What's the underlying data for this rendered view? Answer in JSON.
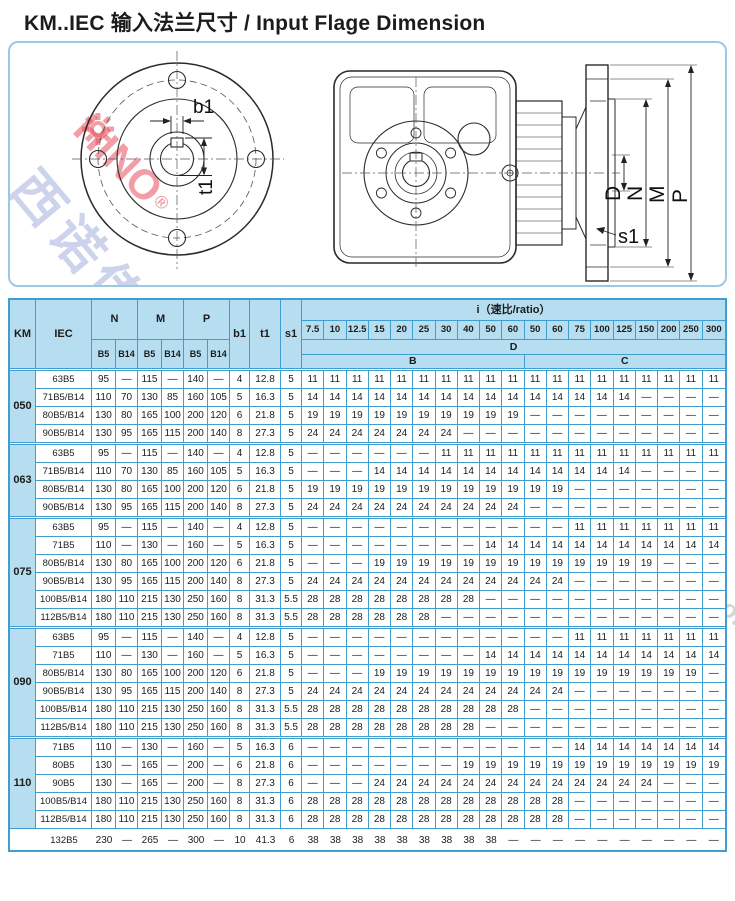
{
  "title": "KM..IEC 输入法兰尺寸 / Input Flage Dimension",
  "diagram": {
    "flange_labels": {
      "b1": "b1",
      "t1": "t1"
    },
    "side_labels": {
      "d": "D",
      "n": "N",
      "m": "M",
      "p": "P",
      "s1": "s1"
    }
  },
  "watermark": {
    "logo_text": "HINO",
    "logo_reg": "®",
    "cn_small": "西诺传动",
    "cn": "陕西西诺传动科技有限公司",
    "en": "Shaanxi Xino Drive Technology Co.,Ltd"
  },
  "table": {
    "header": {
      "km": "KM",
      "iec": "IEC",
      "n": "N",
      "m": "M",
      "p": "P",
      "b5": "B5",
      "b14": "B14",
      "b1": "b1",
      "t1": "t1",
      "s1": "s1",
      "ratio_title": "i（速比/ratio）",
      "ratios": [
        "7.5",
        "10",
        "12.5",
        "15",
        "20",
        "25",
        "30",
        "40",
        "50",
        "60",
        "50",
        "60",
        "75",
        "100",
        "125",
        "150",
        "200",
        "250",
        "300"
      ],
      "d": "D",
      "b": "B",
      "c": "C"
    },
    "groups": [
      {
        "km": "050",
        "rows": [
          {
            "iec": "63B5",
            "dims": [
              "95",
              "—",
              "115",
              "—",
              "140",
              "—",
              "4",
              "12.8",
              "5"
            ],
            "i": [
              "11",
              "11",
              "11",
              "11",
              "11",
              "11",
              "11",
              "11",
              "11",
              "11",
              "11",
              "11",
              "11",
              "11",
              "11",
              "11",
              "11",
              "11",
              "11"
            ]
          },
          {
            "iec": "71B5/B14",
            "dims": [
              "110",
              "70",
              "130",
              "85",
              "160",
              "105",
              "5",
              "16.3",
              "5"
            ],
            "i": [
              "14",
              "14",
              "14",
              "14",
              "14",
              "14",
              "14",
              "14",
              "14",
              "14",
              "14",
              "14",
              "14",
              "14",
              "14",
              "—",
              "—",
              "—",
              "—"
            ]
          },
          {
            "iec": "80B5/B14",
            "dims": [
              "130",
              "80",
              "165",
              "100",
              "200",
              "120",
              "6",
              "21.8",
              "5"
            ],
            "i": [
              "19",
              "19",
              "19",
              "19",
              "19",
              "19",
              "19",
              "19",
              "19",
              "19",
              "—",
              "—",
              "—",
              "—",
              "—",
              "—",
              "—",
              "—",
              "—"
            ]
          },
          {
            "iec": "90B5/B14",
            "dims": [
              "130",
              "95",
              "165",
              "115",
              "200",
              "140",
              "8",
              "27.3",
              "5"
            ],
            "i": [
              "24",
              "24",
              "24",
              "24",
              "24",
              "24",
              "24",
              "—",
              "—",
              "—",
              "—",
              "—",
              "—",
              "—",
              "—",
              "—",
              "—",
              "—",
              "—"
            ]
          }
        ]
      },
      {
        "km": "063",
        "rows": [
          {
            "iec": "63B5",
            "dims": [
              "95",
              "—",
              "115",
              "—",
              "140",
              "—",
              "4",
              "12.8",
              "5"
            ],
            "i": [
              "—",
              "—",
              "—",
              "—",
              "—",
              "—",
              "11",
              "11",
              "11",
              "11",
              "11",
              "11",
              "11",
              "11",
              "11",
              "11",
              "11",
              "11",
              "11"
            ]
          },
          {
            "iec": "71B5/B14",
            "dims": [
              "110",
              "70",
              "130",
              "85",
              "160",
              "105",
              "5",
              "16.3",
              "5"
            ],
            "i": [
              "—",
              "—",
              "—",
              "14",
              "14",
              "14",
              "14",
              "14",
              "14",
              "14",
              "14",
              "14",
              "14",
              "14",
              "14",
              "—",
              "—",
              "—",
              "—"
            ]
          },
          {
            "iec": "80B5/B14",
            "dims": [
              "130",
              "80",
              "165",
              "100",
              "200",
              "120",
              "6",
              "21.8",
              "5"
            ],
            "i": [
              "19",
              "19",
              "19",
              "19",
              "19",
              "19",
              "19",
              "19",
              "19",
              "19",
              "19",
              "19",
              "—",
              "—",
              "—",
              "—",
              "—",
              "—",
              "—"
            ]
          },
          {
            "iec": "90B5/B14",
            "dims": [
              "130",
              "95",
              "165",
              "115",
              "200",
              "140",
              "8",
              "27.3",
              "5"
            ],
            "i": [
              "24",
              "24",
              "24",
              "24",
              "24",
              "24",
              "24",
              "24",
              "24",
              "24",
              "—",
              "—",
              "—",
              "—",
              "—",
              "—",
              "—",
              "—",
              "—"
            ]
          }
        ]
      },
      {
        "km": "075",
        "rows": [
          {
            "iec": "63B5",
            "dims": [
              "95",
              "—",
              "115",
              "—",
              "140",
              "—",
              "4",
              "12.8",
              "5"
            ],
            "i": [
              "—",
              "—",
              "—",
              "—",
              "—",
              "—",
              "—",
              "—",
              "—",
              "—",
              "—",
              "—",
              "11",
              "11",
              "11",
              "11",
              "11",
              "11",
              "11"
            ]
          },
          {
            "iec": "71B5",
            "dims": [
              "110",
              "—",
              "130",
              "—",
              "160",
              "—",
              "5",
              "16.3",
              "5"
            ],
            "i": [
              "—",
              "—",
              "—",
              "—",
              "—",
              "—",
              "—",
              "—",
              "14",
              "14",
              "14",
              "14",
              "14",
              "14",
              "14",
              "14",
              "14",
              "14",
              "14"
            ]
          },
          {
            "iec": "80B5/B14",
            "dims": [
              "130",
              "80",
              "165",
              "100",
              "200",
              "120",
              "6",
              "21.8",
              "5"
            ],
            "i": [
              "—",
              "—",
              "—",
              "19",
              "19",
              "19",
              "19",
              "19",
              "19",
              "19",
              "19",
              "19",
              "19",
              "19",
              "19",
              "19",
              "—",
              "—",
              "—"
            ]
          },
          {
            "iec": "90B5/B14",
            "dims": [
              "130",
              "95",
              "165",
              "115",
              "200",
              "140",
              "8",
              "27.3",
              "5"
            ],
            "i": [
              "24",
              "24",
              "24",
              "24",
              "24",
              "24",
              "24",
              "24",
              "24",
              "24",
              "24",
              "24",
              "—",
              "—",
              "—",
              "—",
              "—",
              "—",
              "—"
            ]
          },
          {
            "iec": "100B5/B14",
            "dims": [
              "180",
              "110",
              "215",
              "130",
              "250",
              "160",
              "8",
              "31.3",
              "5.5"
            ],
            "i": [
              "28",
              "28",
              "28",
              "28",
              "28",
              "28",
              "28",
              "28",
              "—",
              "—",
              "—",
              "—",
              "—",
              "—",
              "—",
              "—",
              "—",
              "—",
              "—"
            ]
          },
          {
            "iec": "112B5/B14",
            "dims": [
              "180",
              "110",
              "215",
              "130",
              "250",
              "160",
              "8",
              "31.3",
              "5.5"
            ],
            "i": [
              "28",
              "28",
              "28",
              "28",
              "28",
              "28",
              "—",
              "—",
              "—",
              "—",
              "—",
              "—",
              "—",
              "—",
              "—",
              "—",
              "—",
              "—",
              "—"
            ]
          }
        ]
      },
      {
        "km": "090",
        "rows": [
          {
            "iec": "63B5",
            "dims": [
              "95",
              "—",
              "115",
              "—",
              "140",
              "—",
              "4",
              "12.8",
              "5"
            ],
            "i": [
              "—",
              "—",
              "—",
              "—",
              "—",
              "—",
              "—",
              "—",
              "—",
              "—",
              "—",
              "—",
              "11",
              "11",
              "11",
              "11",
              "11",
              "11",
              "11"
            ]
          },
          {
            "iec": "71B5",
            "dims": [
              "110",
              "—",
              "130",
              "—",
              "160",
              "—",
              "5",
              "16.3",
              "5"
            ],
            "i": [
              "—",
              "—",
              "—",
              "—",
              "—",
              "—",
              "—",
              "—",
              "14",
              "14",
              "14",
              "14",
              "14",
              "14",
              "14",
              "14",
              "14",
              "14",
              "14"
            ]
          },
          {
            "iec": "80B5/B14",
            "dims": [
              "130",
              "80",
              "165",
              "100",
              "200",
              "120",
              "6",
              "21.8",
              "5"
            ],
            "i": [
              "—",
              "—",
              "—",
              "19",
              "19",
              "19",
              "19",
              "19",
              "19",
              "19",
              "19",
              "19",
              "19",
              "19",
              "19",
              "19",
              "19",
              "19",
              "—"
            ]
          },
          {
            "iec": "90B5/B14",
            "dims": [
              "130",
              "95",
              "165",
              "115",
              "200",
              "140",
              "8",
              "27.3",
              "5"
            ],
            "i": [
              "24",
              "24",
              "24",
              "24",
              "24",
              "24",
              "24",
              "24",
              "24",
              "24",
              "24",
              "24",
              "—",
              "—",
              "—",
              "—",
              "—",
              "—",
              "—"
            ]
          },
          {
            "iec": "100B5/B14",
            "dims": [
              "180",
              "110",
              "215",
              "130",
              "250",
              "160",
              "8",
              "31.3",
              "5.5"
            ],
            "i": [
              "28",
              "28",
              "28",
              "28",
              "28",
              "28",
              "28",
              "28",
              "28",
              "28",
              "—",
              "—",
              "—",
              "—",
              "—",
              "—",
              "—",
              "—",
              "—"
            ]
          },
          {
            "iec": "112B5/B14",
            "dims": [
              "180",
              "110",
              "215",
              "130",
              "250",
              "160",
              "8",
              "31.3",
              "5.5"
            ],
            "i": [
              "28",
              "28",
              "28",
              "28",
              "28",
              "28",
              "28",
              "28",
              "—",
              "—",
              "—",
              "—",
              "—",
              "—",
              "—",
              "—",
              "—",
              "—",
              "—"
            ]
          }
        ]
      },
      {
        "km": "110",
        "rows": [
          {
            "iec": "71B5",
            "dims": [
              "110",
              "—",
              "130",
              "—",
              "160",
              "—",
              "5",
              "16.3",
              "6"
            ],
            "i": [
              "—",
              "—",
              "—",
              "—",
              "—",
              "—",
              "—",
              "—",
              "—",
              "—",
              "—",
              "—",
              "14",
              "14",
              "14",
              "14",
              "14",
              "14",
              "14"
            ]
          },
          {
            "iec": "80B5",
            "dims": [
              "130",
              "—",
              "165",
              "—",
              "200",
              "—",
              "6",
              "21.8",
              "6"
            ],
            "i": [
              "—",
              "—",
              "—",
              "—",
              "—",
              "—",
              "—",
              "19",
              "19",
              "19",
              "19",
              "19",
              "19",
              "19",
              "19",
              "19",
              "19",
              "19",
              "19"
            ]
          },
          {
            "iec": "90B5",
            "dims": [
              "130",
              "—",
              "165",
              "—",
              "200",
              "—",
              "8",
              "27.3",
              "6"
            ],
            "i": [
              "—",
              "—",
              "—",
              "24",
              "24",
              "24",
              "24",
              "24",
              "24",
              "24",
              "24",
              "24",
              "24",
              "24",
              "24",
              "24",
              "—",
              "—",
              "—"
            ]
          },
          {
            "iec": "100B5/B14",
            "dims": [
              "180",
              "110",
              "215",
              "130",
              "250",
              "160",
              "8",
              "31.3",
              "6"
            ],
            "i": [
              "28",
              "28",
              "28",
              "28",
              "28",
              "28",
              "28",
              "28",
              "28",
              "28",
              "28",
              "28",
              "—",
              "—",
              "—",
              "—",
              "—",
              "—",
              "—"
            ]
          },
          {
            "iec": "112B5/B14",
            "dims": [
              "180",
              "110",
              "215",
              "130",
              "250",
              "160",
              "8",
              "31.3",
              "6"
            ],
            "i": [
              "28",
              "28",
              "28",
              "28",
              "28",
              "28",
              "28",
              "28",
              "28",
              "28",
              "28",
              "28",
              "—",
              "—",
              "—",
              "—",
              "—",
              "—",
              "—"
            ]
          }
        ]
      }
    ],
    "tail_row": {
      "iec": "132B5",
      "dims": [
        "230",
        "—",
        "265",
        "—",
        "300",
        "—",
        "10",
        "41.3",
        "6"
      ],
      "i": [
        "38",
        "38",
        "38",
        "38",
        "38",
        "38",
        "38",
        "38",
        "38",
        "—",
        "—",
        "—",
        "—",
        "—",
        "—",
        "—",
        "—",
        "—",
        "—"
      ]
    }
  }
}
